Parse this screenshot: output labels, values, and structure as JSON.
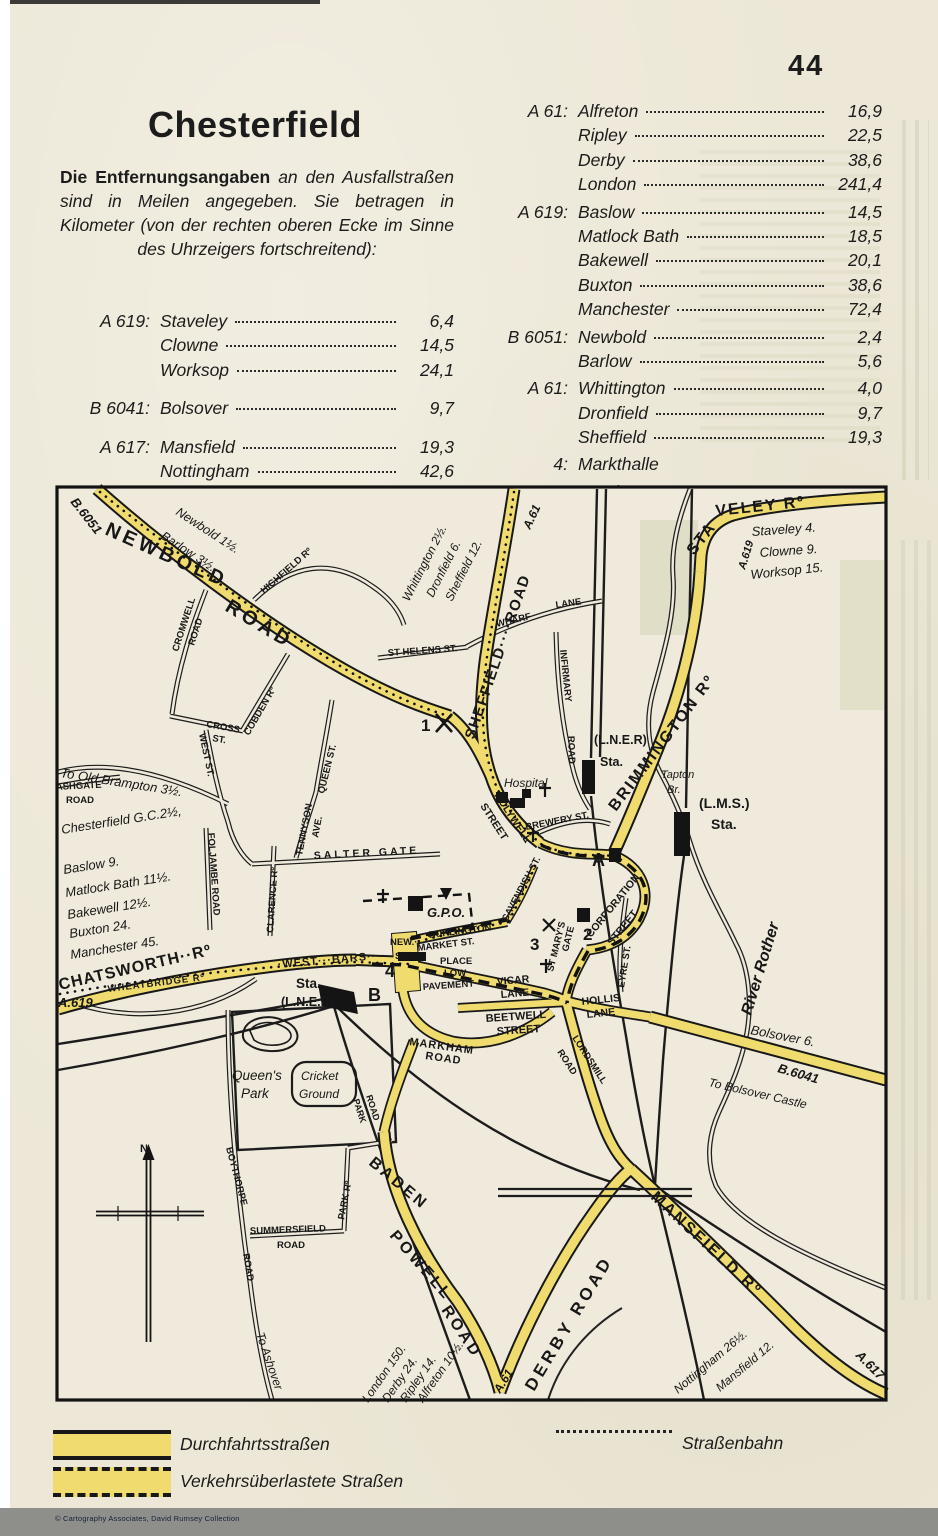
{
  "page": {
    "number": "44",
    "copyright": "© Cartography Associates, David Rumsey Collection"
  },
  "header": {
    "title": "Chesterfield",
    "intro_bold": "Die Entfernungsangaben",
    "intro_rest": " an den Aus­fallstraßen sind in Meilen angegeben. Sie betragen in Kilometer (von der rechten oberen Ecke im Sinne des Uhrzeigers fortschreitend):"
  },
  "distance_table": {
    "left": [
      {
        "road": "A 619:",
        "entries": [
          [
            "Staveley",
            "6,4"
          ],
          [
            "Clowne",
            "14,5"
          ],
          [
            "Worksop",
            "24,1"
          ]
        ]
      },
      {
        "road": "B 6041:",
        "entries": [
          [
            "Bolsover",
            "9,7"
          ]
        ]
      },
      {
        "road": "A 617:",
        "entries": [
          [
            "Mansfield",
            "19,3"
          ],
          [
            "Nottingham",
            "42,6"
          ]
        ]
      }
    ],
    "right": [
      {
        "road": "A 61:",
        "entries": [
          [
            "Alfreton",
            "16,9"
          ],
          [
            "Ripley",
            "22,5"
          ],
          [
            "Derby",
            "38,6"
          ],
          [
            "London",
            "241,4"
          ]
        ]
      },
      {
        "road": "A 619:",
        "entries": [
          [
            "Baslow",
            "14,5"
          ],
          [
            "Matlock Bath",
            "18,5"
          ],
          [
            "Bakewell",
            "20,1"
          ],
          [
            "Buxton",
            "38,6"
          ],
          [
            "Manchester",
            "72,4"
          ]
        ]
      },
      {
        "road": "B 6051:",
        "entries": [
          [
            "Newbold",
            "2,4"
          ],
          [
            "Barlow",
            "5,6"
          ]
        ]
      },
      {
        "road": "A 61:",
        "entries": [
          [
            "Whittington",
            "4,0"
          ],
          [
            "Dronfield",
            "9,7"
          ],
          [
            "Sheffield",
            "19,3"
          ]
        ]
      },
      {
        "road": "4:",
        "entries": [
          [
            "Markthalle",
            ""
          ]
        ]
      },
      {
        "road": "A, B:",
        "entries": [
          [
            "Hotels",
            ""
          ]
        ]
      }
    ]
  },
  "legend": {
    "through_roads": "Durchfahrtsstraßen",
    "congested_roads": "Verkehrsüberlastete Straßen",
    "tram": "Straßenbahn"
  },
  "map": {
    "road_color": "#f0dc6e",
    "labels": [
      {
        "t": "NEWBOLD",
        "c": "rb",
        "x": 104,
        "y": 534,
        "r": 24,
        "s": 20,
        "ls": 4
      },
      {
        "t": "ROAD",
        "c": "rb",
        "x": 224,
        "y": 610,
        "r": 31,
        "s": 20,
        "ls": 4
      },
      {
        "t": "SHEFFIELD····ROAD",
        "c": "rb",
        "x": 474,
        "y": 740,
        "r": -71,
        "s": 15,
        "ls": 1.5
      },
      {
        "t": "STA",
        "c": "rb",
        "x": 694,
        "y": 556,
        "r": -52,
        "s": 16,
        "ls": 2
      },
      {
        "t": "VELEY Rº",
        "c": "rb",
        "x": 716,
        "y": 516,
        "r": -6,
        "s": 16,
        "ls": 2
      },
      {
        "t": "BRIMMINGTON Rº",
        "c": "rb",
        "x": 616,
        "y": 812,
        "r": -53,
        "s": 16,
        "ls": 2
      },
      {
        "t": "CHATSWORTH··Rº",
        "c": "rb",
        "x": 60,
        "y": 990,
        "r": -13,
        "s": 16,
        "ls": 1
      },
      {
        "t": "·WEST···BARS··",
        "c": "rs",
        "x": 278,
        "y": 968,
        "r": -5,
        "s": 11,
        "ls": 1
      },
      {
        "t": "DERBY ROAD",
        "c": "rb",
        "x": 534,
        "y": 1392,
        "r": -59,
        "s": 17,
        "ls": 4
      },
      {
        "t": "BADEN",
        "c": "rb",
        "x": 368,
        "y": 1164,
        "r": 40,
        "s": 16,
        "ls": 3
      },
      {
        "t": "POWELL",
        "c": "rb",
        "x": 389,
        "y": 1236,
        "r": 49,
        "s": 16,
        "ls": 3
      },
      {
        "t": "ROAD",
        "c": "rb",
        "x": 441,
        "y": 1310,
        "r": 56,
        "s": 16,
        "ls": 3
      },
      {
        "t": "MANSFIELD Rº",
        "c": "rb",
        "x": 650,
        "y": 1198,
        "r": 43,
        "s": 16,
        "ls": 2.5
      },
      {
        "t": "HIGHFIELD Rº",
        "c": "rs",
        "x": 264,
        "y": 594,
        "r": -41,
        "s": 9.5
      },
      {
        "t": "CROMWELL",
        "c": "rs",
        "x": 178,
        "y": 652,
        "r": -72,
        "s": 9.5
      },
      {
        "t": "ROAD",
        "c": "rs",
        "x": 194,
        "y": 646,
        "r": -72,
        "s": 9.5
      },
      {
        "t": "CROSS",
        "c": "rs",
        "x": 206,
        "y": 727,
        "r": 10,
        "s": 9.5
      },
      {
        "t": "ST.",
        "c": "rs",
        "x": 212,
        "y": 741,
        "r": 10,
        "s": 9.5
      },
      {
        "t": "COBDEN Rº",
        "c": "rs",
        "x": 249,
        "y": 736,
        "r": -60,
        "s": 9.5
      },
      {
        "t": "WEST ST.",
        "c": "rs",
        "x": 199,
        "y": 734,
        "r": 78,
        "s": 9.5
      },
      {
        "t": "QUEEN ST.",
        "c": "rs",
        "x": 324,
        "y": 794,
        "r": -76,
        "s": 9.5
      },
      {
        "t": "TENNYSON",
        "c": "rs",
        "x": 302,
        "y": 856,
        "r": -79,
        "s": 9.5
      },
      {
        "t": "AVE.",
        "c": "rs",
        "x": 318,
        "y": 838,
        "r": -79,
        "s": 9.5
      },
      {
        "t": "ST HELENS ST.",
        "c": "rs",
        "x": 388,
        "y": 656,
        "r": -4,
        "s": 9.5
      },
      {
        "t": "WHARF",
        "c": "rs",
        "x": 497,
        "y": 627,
        "r": -13,
        "s": 9.5
      },
      {
        "t": "LANE",
        "c": "rs",
        "x": 556,
        "y": 608,
        "r": -8,
        "s": 9.5
      },
      {
        "t": "INFIRMARY",
        "c": "rs",
        "x": 560,
        "y": 650,
        "r": 84,
        "s": 9.5
      },
      {
        "t": "ROAD",
        "c": "rs",
        "x": 568,
        "y": 736,
        "r": 88,
        "s": 9.5
      },
      {
        "t": "ASHGATE",
        "c": "rs",
        "x": 56,
        "y": 790,
        "r": -3,
        "s": 9.5
      },
      {
        "t": "ROAD",
        "c": "rs",
        "x": 66,
        "y": 803,
        "r": 0,
        "s": 9.5
      },
      {
        "t": "SALTER GATE",
        "c": "rs",
        "x": 314,
        "y": 859,
        "r": -3,
        "s": 10.5,
        "ls": 3
      },
      {
        "t": "FOLJAMBE ROAD",
        "c": "rs",
        "x": 208,
        "y": 833,
        "r": 86,
        "s": 9.5
      },
      {
        "t": "CLARENCE Rº",
        "c": "rs",
        "x": 273,
        "y": 933,
        "r": -86,
        "s": 9.5
      },
      {
        "t": "WHEATBRIDGE Rº",
        "c": "rs",
        "x": 108,
        "y": 992,
        "r": -7,
        "s": 9.5,
        "ls": 1
      },
      {
        "t": "BREWERY ST.",
        "c": "rs",
        "x": 526,
        "y": 830,
        "r": -11,
        "s": 9.5
      },
      {
        "t": "EYRE ST.",
        "c": "rs",
        "x": 624,
        "y": 988,
        "r": -81,
        "s": 9.5
      },
      {
        "t": "HOLYWELL",
        "c": "rs",
        "x": 494,
        "y": 795,
        "r": 57,
        "s": 10.5
      },
      {
        "t": "STREET",
        "c": "rs",
        "x": 480,
        "y": 806,
        "r": 57,
        "s": 10.5
      },
      {
        "t": "CORPORATION",
        "c": "rs",
        "x": 591,
        "y": 938,
        "r": -51,
        "s": 10.5
      },
      {
        "t": "STREET",
        "c": "rs",
        "x": 612,
        "y": 946,
        "r": -51,
        "s": 10.5
      },
      {
        "t": "CAVENDISH ST.",
        "c": "rs",
        "x": 507,
        "y": 922,
        "r": -62,
        "s": 9.5
      },
      {
        "t": "ST MARY'S",
        "c": "rs",
        "x": 553,
        "y": 972,
        "r": -76,
        "s": 9.5
      },
      {
        "t": "GATE",
        "c": "rs",
        "x": 568,
        "y": 952,
        "r": -76,
        "s": 9.5
      },
      {
        "t": "BURLINGTON",
        "c": "rs",
        "x": 429,
        "y": 938,
        "r": -7,
        "s": 9.5
      },
      {
        "t": "MARKET ST.",
        "c": "rs",
        "x": 418,
        "y": 951,
        "r": -7,
        "s": 9.5
      },
      {
        "t": "PLACE",
        "c": "rs",
        "x": 440,
        "y": 964,
        "r": 0,
        "s": 9.5
      },
      {
        "t": "LOW",
        "c": "rs",
        "x": 444,
        "y": 976,
        "r": 0,
        "s": 9.5
      },
      {
        "t": "PAVEMENT",
        "c": "rs",
        "x": 423,
        "y": 990,
        "r": -4,
        "s": 9.5
      },
      {
        "t": "NEW.··",
        "c": "rs",
        "x": 390,
        "y": 945,
        "r": 0,
        "s": 9.5
      },
      {
        "t": "SQ.·",
        "c": "rs",
        "x": 395,
        "y": 959,
        "r": 0,
        "s": 9.5
      },
      {
        "t": "VICAR",
        "c": "rs",
        "x": 497,
        "y": 985,
        "r": -5,
        "s": 10.5
      },
      {
        "t": "LANE",
        "c": "rs",
        "x": 501,
        "y": 998,
        "r": -5,
        "s": 10.5
      },
      {
        "t": "BEETWELL",
        "c": "rs",
        "x": 486,
        "y": 1022,
        "r": -4,
        "s": 11
      },
      {
        "t": "STREET",
        "c": "rs",
        "x": 497,
        "y": 1035,
        "r": -4,
        "s": 11
      },
      {
        "t": "MARKHAM",
        "c": "rs",
        "x": 409,
        "y": 1045,
        "r": 8,
        "s": 11,
        "ls": 1
      },
      {
        "t": "ROAD",
        "c": "rs",
        "x": 425,
        "y": 1059,
        "r": 8,
        "s": 11,
        "ls": 1
      },
      {
        "t": "HOLLIS",
        "c": "rs",
        "x": 582,
        "y": 1005,
        "r": -6,
        "s": 10.5
      },
      {
        "t": "LANE",
        "c": "rs",
        "x": 587,
        "y": 1018,
        "r": -6,
        "s": 10.5
      },
      {
        "t": "LORDSMILL",
        "c": "rs",
        "x": 572,
        "y": 1038,
        "r": 57,
        "s": 9.5
      },
      {
        "t": "ROAD",
        "c": "rs",
        "x": 557,
        "y": 1052,
        "r": 57,
        "s": 9.5
      },
      {
        "t": "PARK",
        "c": "rs",
        "x": 353,
        "y": 1100,
        "r": 72,
        "s": 9
      },
      {
        "t": "ROAD",
        "c": "rs",
        "x": 366,
        "y": 1096,
        "r": 72,
        "s": 9
      },
      {
        "t": "PARK Rº",
        "c": "rs",
        "x": 344,
        "y": 1220,
        "r": -79,
        "s": 9.5
      },
      {
        "t": "SUMMERSFIELD",
        "c": "rs",
        "x": 250,
        "y": 1234,
        "r": -2,
        "s": 9.5
      },
      {
        "t": "ROAD",
        "c": "rs",
        "x": 277,
        "y": 1248,
        "r": 0,
        "s": 9.5
      },
      {
        "t": "BOYTHORPE",
        "c": "rs",
        "x": 226,
        "y": 1148,
        "r": 75,
        "s": 9.5
      },
      {
        "t": "ROAD",
        "c": "rs",
        "x": 243,
        "y": 1254,
        "r": 80,
        "s": 9.5
      },
      {
        "t": "B.6051",
        "c": "ib",
        "x": 70,
        "y": 502,
        "r": 52,
        "s": 13
      },
      {
        "t": "Newbold 1½.",
        "c": "it",
        "x": 175,
        "y": 514,
        "r": 33,
        "s": 12.5
      },
      {
        "t": "Barlow 3½.",
        "c": "it",
        "x": 160,
        "y": 538,
        "r": 33,
        "s": 12.5
      },
      {
        "t": "Whittington 2½.",
        "c": "it",
        "x": 409,
        "y": 602,
        "r": -63,
        "s": 12
      },
      {
        "t": "Dronfield 6.",
        "c": "it",
        "x": 433,
        "y": 598,
        "r": -63,
        "s": 12
      },
      {
        "t": "Sheffield 12.",
        "c": "it",
        "x": 452,
        "y": 602,
        "r": -63,
        "s": 12
      },
      {
        "t": "A.61",
        "c": "ib",
        "x": 530,
        "y": 530,
        "r": -65,
        "s": 12
      },
      {
        "t": "A.619",
        "c": "ib",
        "x": 745,
        "y": 570,
        "r": -73,
        "s": 11
      },
      {
        "t": "Staveley 4.",
        "c": "it",
        "x": 752,
        "y": 536,
        "r": -4,
        "s": 13
      },
      {
        "t": "Clowne 9.",
        "c": "it",
        "x": 760,
        "y": 557,
        "r": -4,
        "s": 13
      },
      {
        "t": "Worksop 15.",
        "c": "it",
        "x": 751,
        "y": 579,
        "r": -6,
        "s": 13
      },
      {
        "t": "(L.N.E.R)",
        "c": "b",
        "x": 594,
        "y": 744,
        "r": 0,
        "s": 12.5
      },
      {
        "t": "Sta.",
        "c": "b",
        "x": 600,
        "y": 766,
        "r": 0,
        "s": 12.5
      },
      {
        "t": "Tapton",
        "c": "it",
        "x": 661,
        "y": 778,
        "r": 0,
        "s": 11
      },
      {
        "t": "Br.",
        "c": "it",
        "x": 667,
        "y": 793,
        "r": 0,
        "s": 11
      },
      {
        "t": "(L.M.S.)",
        "c": "b",
        "x": 699,
        "y": 808,
        "r": 0,
        "s": 14
      },
      {
        "t": "Sta.",
        "c": "b",
        "x": 711,
        "y": 829,
        "r": 0,
        "s": 14
      },
      {
        "t": "River Rother",
        "c": "ib",
        "x": 751,
        "y": 1016,
        "r": -73,
        "s": 16
      },
      {
        "t": "Hospital",
        "c": "it",
        "x": 504,
        "y": 787,
        "r": 0,
        "s": 12
      },
      {
        "t": "G.P.O.",
        "c": "ib",
        "x": 427,
        "y": 917,
        "r": 0,
        "s": 13
      },
      {
        "t": "Chesterfield G.C.2½,",
        "c": "it",
        "x": 62,
        "y": 834,
        "r": -9,
        "s": 13
      },
      {
        "t": "Baslow 9.",
        "c": "it",
        "x": 64,
        "y": 874,
        "r": -9,
        "s": 13
      },
      {
        "t": "Matlock Bath 11½.",
        "c": "it",
        "x": 66,
        "y": 897,
        "r": -9,
        "s": 13
      },
      {
        "t": "Bakewell 12½.",
        "c": "it",
        "x": 68,
        "y": 919,
        "r": -9,
        "s": 13
      },
      {
        "t": "Buxton 24.",
        "c": "it",
        "x": 70,
        "y": 938,
        "r": -9,
        "s": 13
      },
      {
        "t": "Manchester 45.",
        "c": "it",
        "x": 71,
        "y": 959,
        "r": -9,
        "s": 13
      },
      {
        "t": "To Old Brampton 3½.",
        "c": "it",
        "x": 60,
        "y": 777,
        "r": 9,
        "s": 13
      },
      {
        "t": "A.619",
        "c": "ib",
        "x": 58,
        "y": 1007,
        "r": 0,
        "s": 13
      },
      {
        "t": "Bolsover 6.",
        "c": "it",
        "x": 750,
        "y": 1034,
        "r": 11,
        "s": 13
      },
      {
        "t": "B.6041",
        "c": "ib",
        "x": 777,
        "y": 1072,
        "r": 16,
        "s": 13
      },
      {
        "t": "To Bolsover Castle",
        "c": "it",
        "x": 708,
        "y": 1086,
        "r": 13,
        "s": 12
      },
      {
        "t": "Mansfield 12.",
        "c": "it",
        "x": 720,
        "y": 1392,
        "r": -40,
        "s": 12
      },
      {
        "t": "Nottingham 26½.",
        "c": "it",
        "x": 678,
        "y": 1394,
        "r": -40,
        "s": 12
      },
      {
        "t": "A.617",
        "c": "ib",
        "x": 855,
        "y": 1356,
        "r": 45,
        "s": 13
      },
      {
        "t": "A.61",
        "c": "ib",
        "x": 500,
        "y": 1394,
        "r": -58,
        "s": 12
      },
      {
        "t": "Alfreton 10½.",
        "c": "it",
        "x": 423,
        "y": 1403,
        "r": -55,
        "s": 12
      },
      {
        "t": "Ripley 14.",
        "c": "it",
        "x": 406,
        "y": 1403,
        "r": -55,
        "s": 12
      },
      {
        "t": "Derby 24.",
        "c": "it",
        "x": 388,
        "y": 1403,
        "r": -55,
        "s": 12
      },
      {
        "t": "London 150.",
        "c": "it",
        "x": 368,
        "y": 1403,
        "r": -55,
        "s": 12
      },
      {
        "t": "To Ashover",
        "c": "it",
        "x": 256,
        "y": 1334,
        "r": 71,
        "s": 12
      },
      {
        "t": "Queen's",
        "c": "it",
        "x": 232,
        "y": 1080,
        "r": 0,
        "s": 13.5
      },
      {
        "t": "Park",
        "c": "it",
        "x": 241,
        "y": 1098,
        "r": 0,
        "s": 13.5
      },
      {
        "t": "Cricket",
        "c": "it",
        "x": 301,
        "y": 1080,
        "r": 0,
        "s": 12
      },
      {
        "t": "Ground",
        "c": "it",
        "x": 299,
        "y": 1098,
        "r": 0,
        "s": 12
      },
      {
        "t": "N.",
        "c": "b",
        "x": 140,
        "y": 1152,
        "r": 0,
        "s": 11
      },
      {
        "t": "Sta.",
        "c": "b",
        "x": 296,
        "y": 988,
        "r": 0,
        "s": 13.5
      },
      {
        "t": "(L.N.E.R)",
        "c": "b",
        "x": 281,
        "y": 1006,
        "r": 0,
        "s": 12.5
      },
      {
        "t": "1",
        "c": "mk",
        "x": 421,
        "y": 731,
        "r": 0,
        "s": 17
      },
      {
        "t": "2",
        "c": "mk",
        "x": 583,
        "y": 940,
        "r": 0,
        "s": 17
      },
      {
        "t": "3",
        "c": "mk",
        "x": 530,
        "y": 950,
        "r": 0,
        "s": 17
      },
      {
        "t": "4",
        "c": "mk",
        "x": 385,
        "y": 977,
        "r": 0,
        "s": 18
      },
      {
        "t": "A",
        "c": "mk",
        "x": 592,
        "y": 866,
        "r": 0,
        "s": 18
      },
      {
        "t": "B",
        "c": "mk",
        "x": 368,
        "y": 1001,
        "r": 0,
        "s": 18
      }
    ]
  }
}
